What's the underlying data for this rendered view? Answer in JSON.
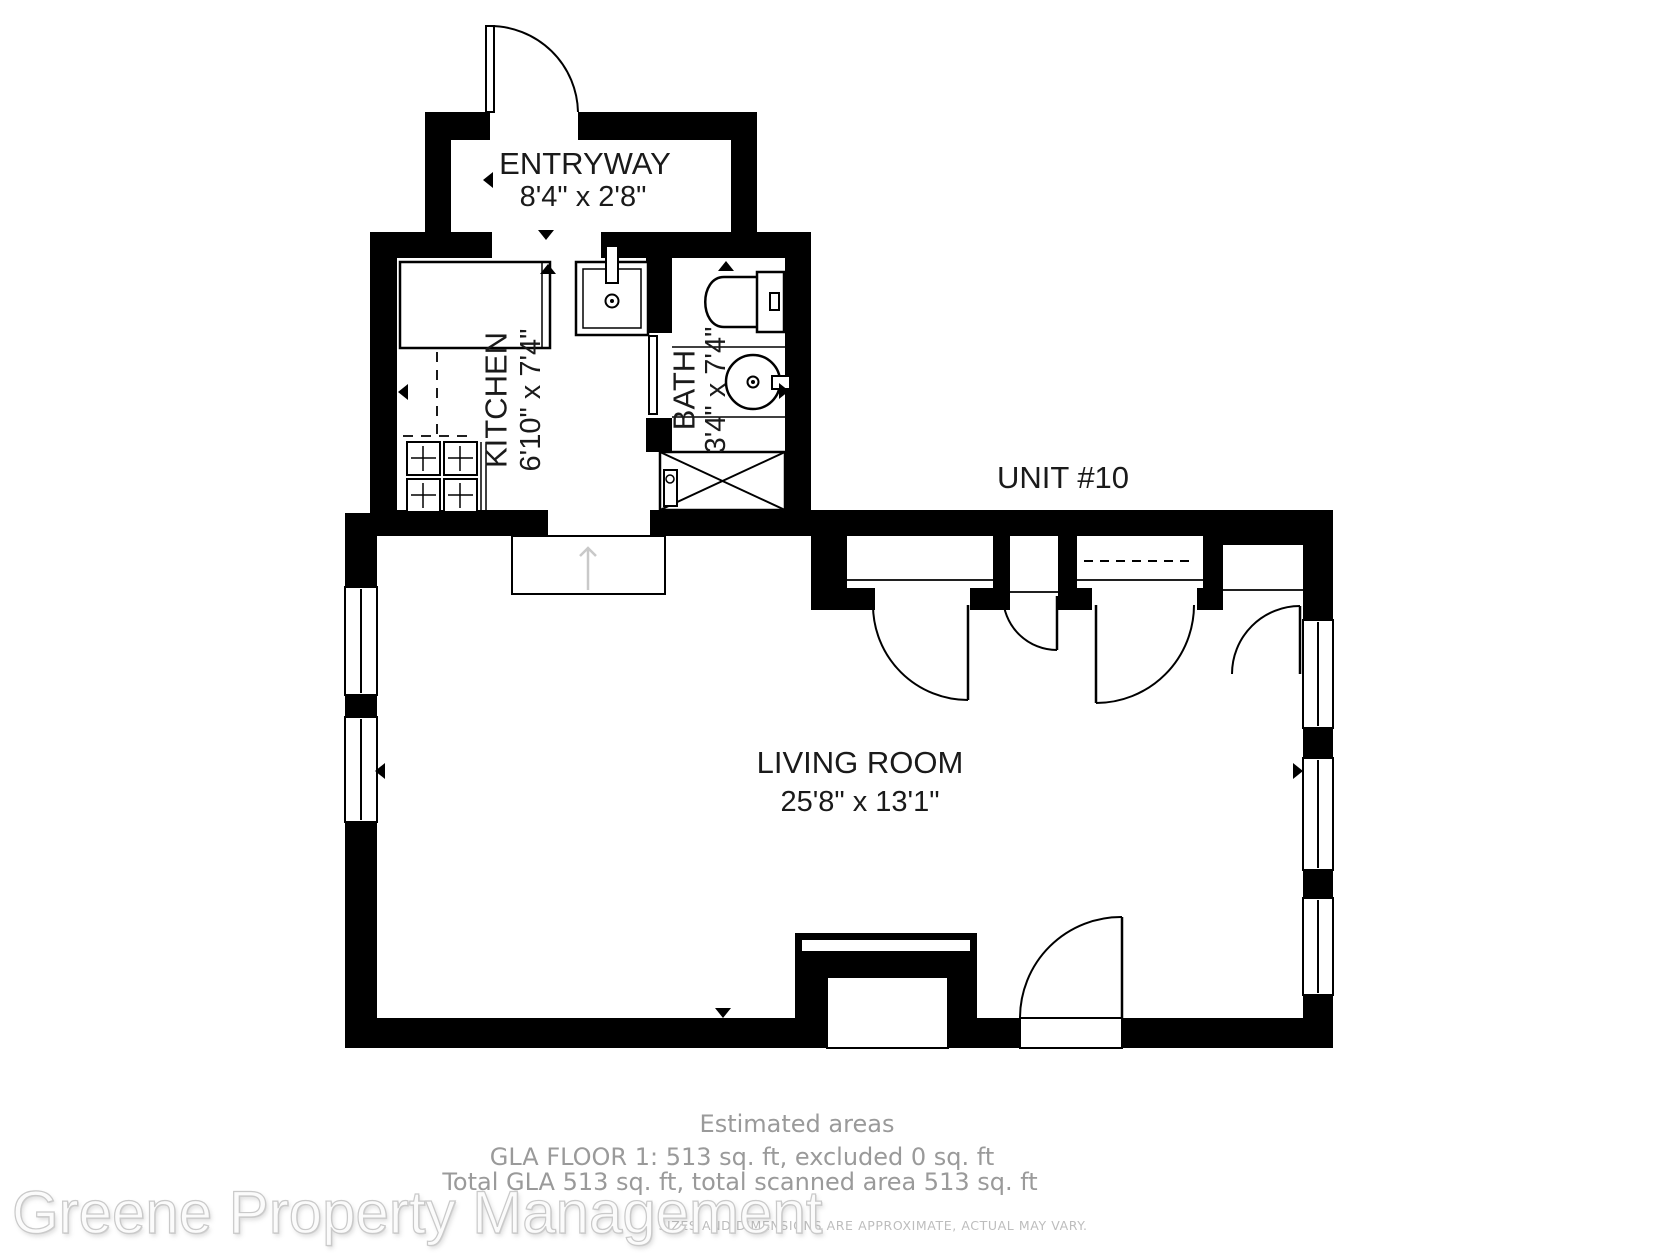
{
  "plan": {
    "unit_label": "UNIT #10",
    "rooms": {
      "entryway": {
        "name": "ENTRYWAY",
        "dimensions": "8'4\" x 2'8\""
      },
      "kitchen": {
        "name": "KITCHEN",
        "dimensions": "6'10\" x 7'4\""
      },
      "bath": {
        "name": "BATH",
        "dimensions": "3'4\" x 7'4\""
      },
      "living_room": {
        "name": "LIVING ROOM",
        "dimensions": "25'8\" x 13'1\""
      }
    },
    "fixtures": [
      "refrigerator",
      "kitchen-counter",
      "stove",
      "kitchen-sink",
      "toilet",
      "bathroom-sink",
      "shower"
    ]
  },
  "footer": {
    "estimated_areas_heading": "Estimated areas",
    "gla_floor_line": "GLA FLOOR 1: 513 sq. ft, excluded 0 sq. ft",
    "total_gla_line": "Total GLA 513 sq. ft, total scanned area 513 sq. ft",
    "disclaimer": "SIZES AND DIMENSIONS ARE APPROXIMATE, ACTUAL MAY VARY."
  },
  "watermark_text": "Greene Property Management",
  "colors": {
    "wall": "#000000",
    "background": "#ffffff",
    "label_text": "#1a1a1a",
    "footer_text": "#9a9a9a",
    "disclaimer_text": "#bdbdbd",
    "watermark_outline": "#c9c9c9",
    "flow_arrow": "#c9c9c9"
  }
}
